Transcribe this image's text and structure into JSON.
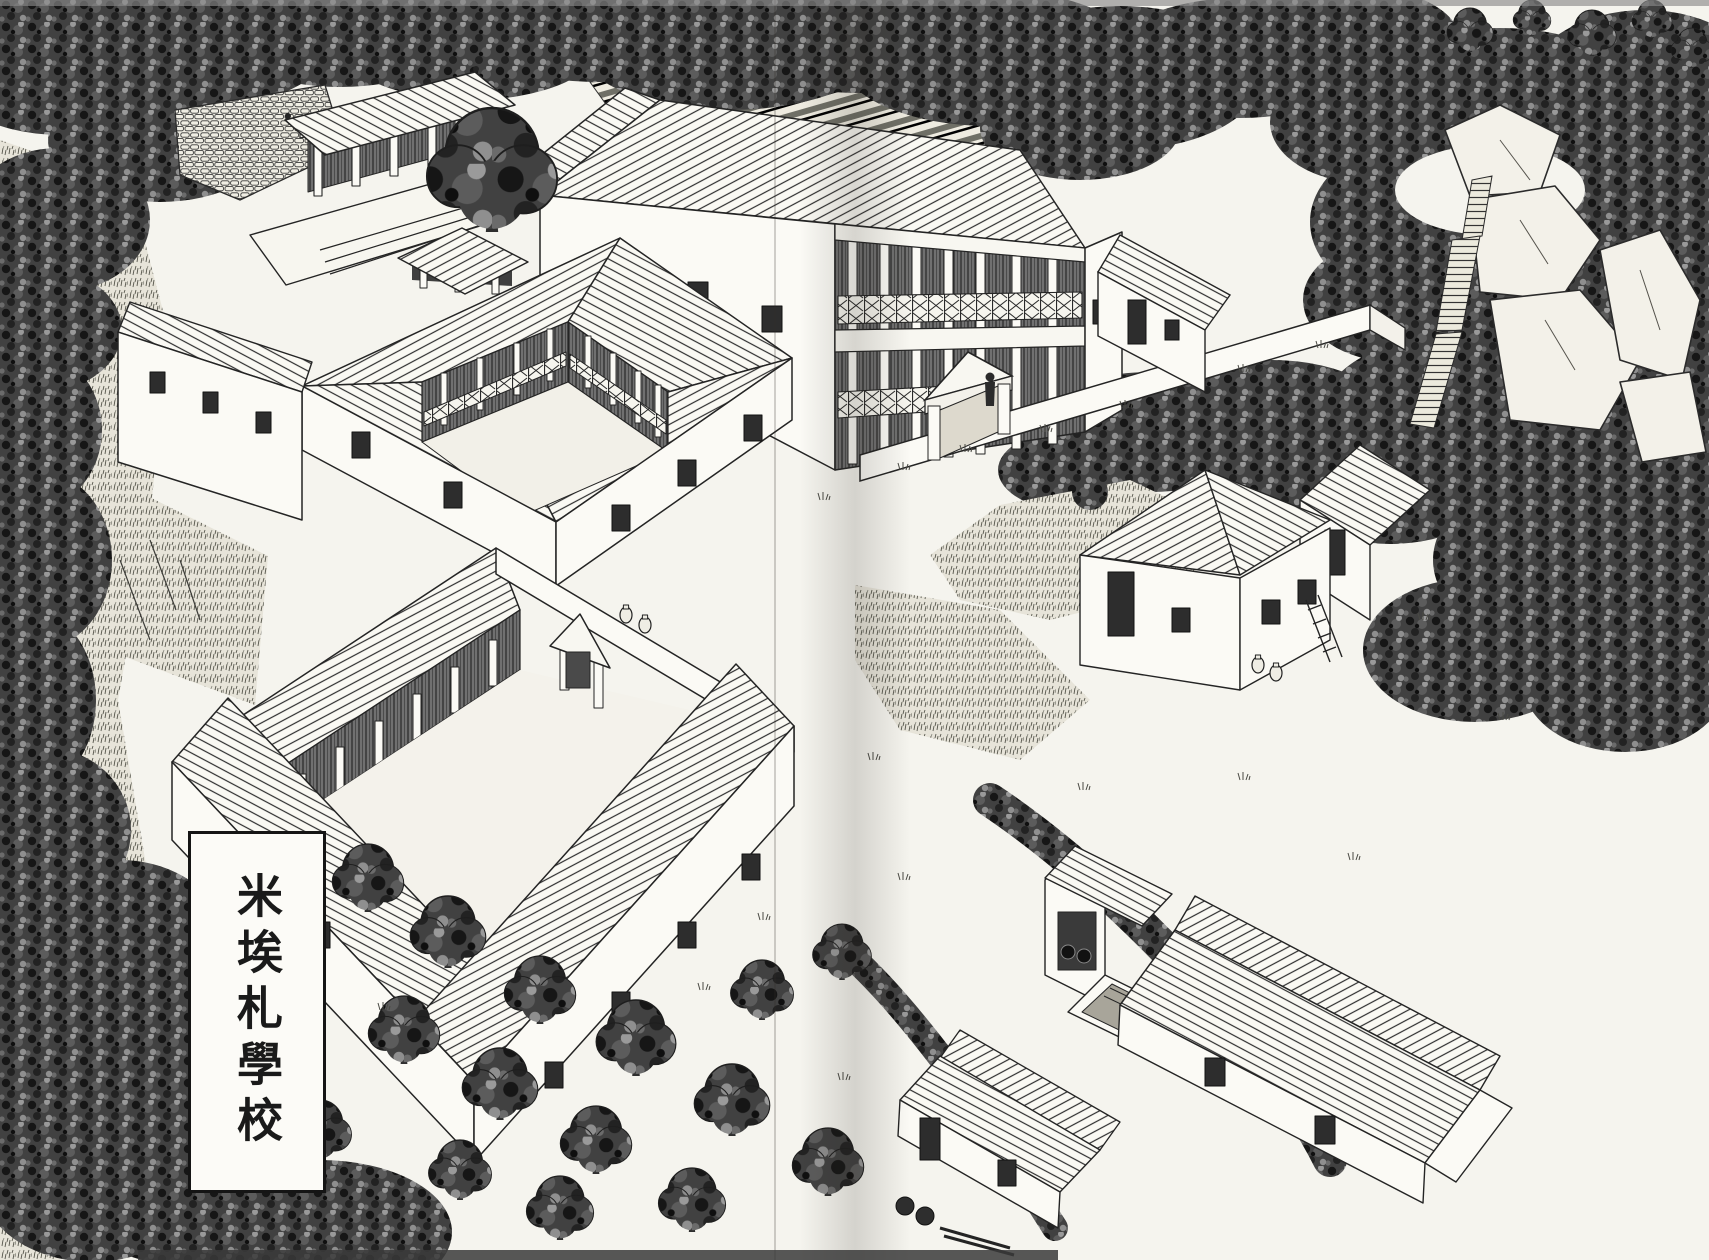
{
  "label_box": {
    "text": "米埃札學校"
  },
  "colors": {
    "paper": "#f5f4ee",
    "ink": "#242424",
    "foliage": "#414141",
    "water": "#a8a59a",
    "fold_shadow": "rgba(40,36,30,0.16)"
  },
  "scene": {
    "landmarks": [
      "temple-on-terrace",
      "sacred-tree",
      "gatehouse",
      "terraced-garden",
      "two-story-hall",
      "hall-courtyard-wall",
      "pediment-gate",
      "courtyard-figure",
      "east-wing",
      "peristyle-building",
      "west-annex",
      "great-court-building",
      "north-stoa-colonnade",
      "entrance-porch",
      "amphorae",
      "farmhouse",
      "rear-outbuilding",
      "spring-house",
      "water-basin",
      "barn",
      "field-shed",
      "olive-grove",
      "scrub-fields",
      "hedgerows",
      "rocky-crag",
      "stone-stairway",
      "forest-canopy"
    ]
  }
}
